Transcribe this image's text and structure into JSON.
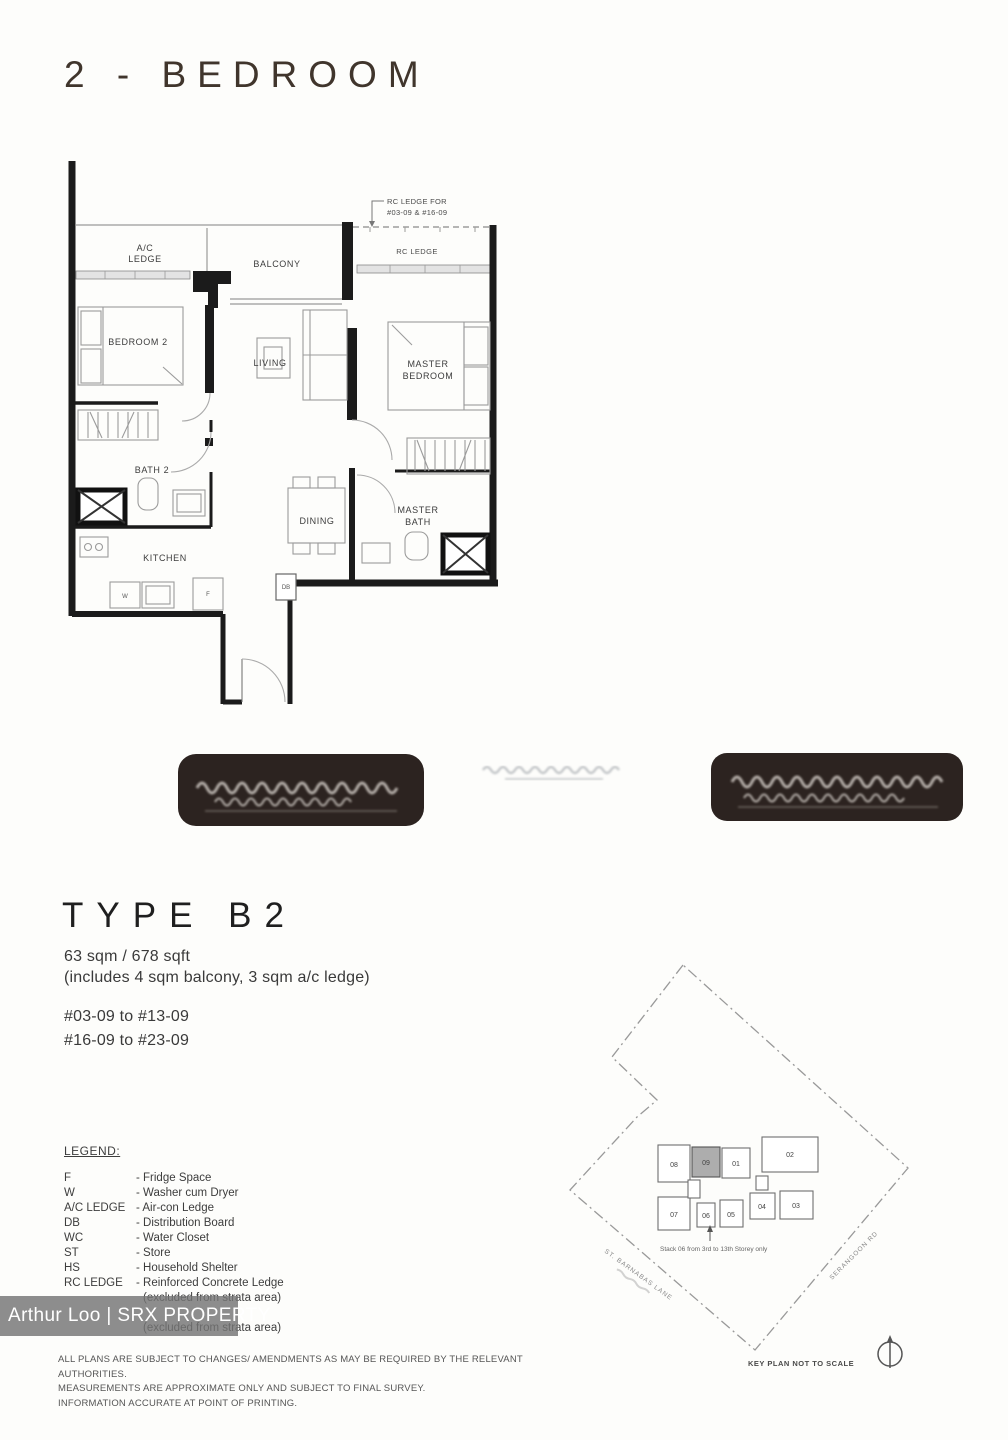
{
  "page": {
    "title": "2 - BEDROOM"
  },
  "floorplan": {
    "annotation1": "RC LEDGE FOR",
    "annotation2": "#03-09 & #16-09",
    "labels": {
      "ac1": "A/C",
      "ac2": "LEDGE",
      "balcony": "BALCONY",
      "rc_ledge": "RC LEDGE",
      "bedroom2": "BEDROOM 2",
      "living": "LIVING",
      "master1": "MASTER",
      "master2": "BEDROOM",
      "bath2": "BATH 2",
      "dining": "DINING",
      "mbath1": "MASTER",
      "mbath2": "BATH",
      "kitchen": "KITCHEN",
      "db": "DB",
      "w": "W",
      "f": "F"
    }
  },
  "unit": {
    "type": "TYPE B2",
    "area": "63 sqm / 678 sqft",
    "area_note": "(includes 4 sqm balcony, 3 sqm a/c ledge)",
    "stack1": "#03-09 to #13-09",
    "stack2": "#16-09 to #23-09"
  },
  "legend": {
    "heading": "LEGEND:",
    "lines": [
      {
        "term": "F",
        "desc": "- Fridge Space"
      },
      {
        "term": "W",
        "desc": "- Washer cum Dryer"
      },
      {
        "term": "A/C LEDGE",
        "desc": "- Air-con Ledge"
      },
      {
        "term": "DB",
        "desc": "- Distribution Board"
      },
      {
        "term": "WC",
        "desc": "- Water Closet"
      },
      {
        "term": "ST",
        "desc": "- Store"
      },
      {
        "term": "HS",
        "desc": "- Household Shelter"
      },
      {
        "term": "RC LEDGE",
        "desc": "- Reinforced Concrete Ledge"
      },
      {
        "term": "",
        "desc": "(excluded from strata area)"
      },
      {
        "term": "",
        "desc": ""
      },
      {
        "term": "",
        "desc": "(excluded from strata area)"
      }
    ]
  },
  "watermark": {
    "text": "Arthur Loo | SRX PROPERTY"
  },
  "disclaimer": [
    "ALL PLANS ARE SUBJECT TO CHANGES/ AMENDMENTS AS MAY BE REQUIRED BY THE RELEVANT AUTHORITIES.",
    "MEASUREMENTS ARE APPROXIMATE ONLY AND SUBJECT TO FINAL SURVEY.",
    "INFORMATION ACCURATE AT POINT OF PRINTING."
  ],
  "keyplan": {
    "units": [
      "08",
      "09",
      "01",
      "02",
      "07",
      "06",
      "05",
      "04",
      "03"
    ],
    "highlight_unit": "09",
    "stack_note": "Stack 06 from 3rd to 13th Storey only",
    "road_left": "ST. BARNABAS LANE",
    "road_right": "SERANGOON RD",
    "caption": "KEY PLAN NOT TO SCALE",
    "highlight_color": "#adadad"
  }
}
